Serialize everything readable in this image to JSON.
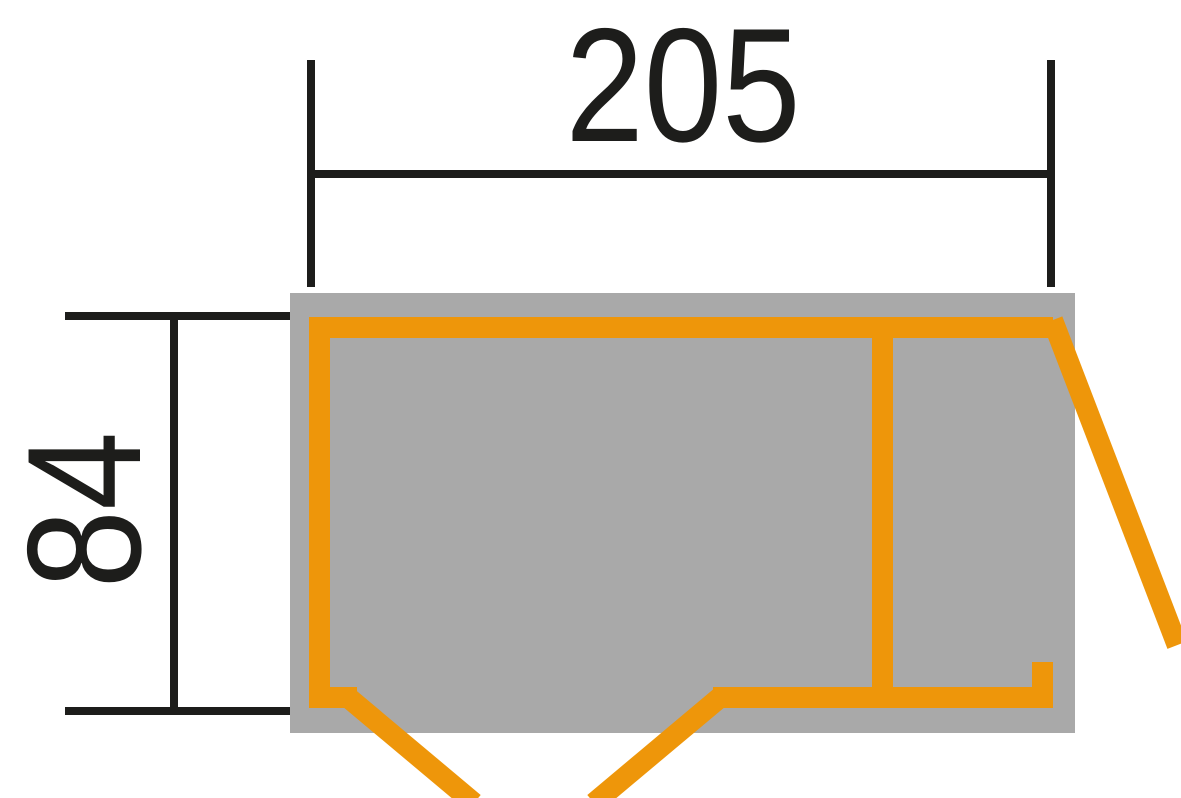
{
  "drawing": {
    "width_dimension_label": "205",
    "depth_dimension_label": "84",
    "colors": {
      "wall": "#ee960a",
      "floor": "#a9a9a9",
      "dimension": "#1d1d1b",
      "background": "#ffffff"
    }
  }
}
